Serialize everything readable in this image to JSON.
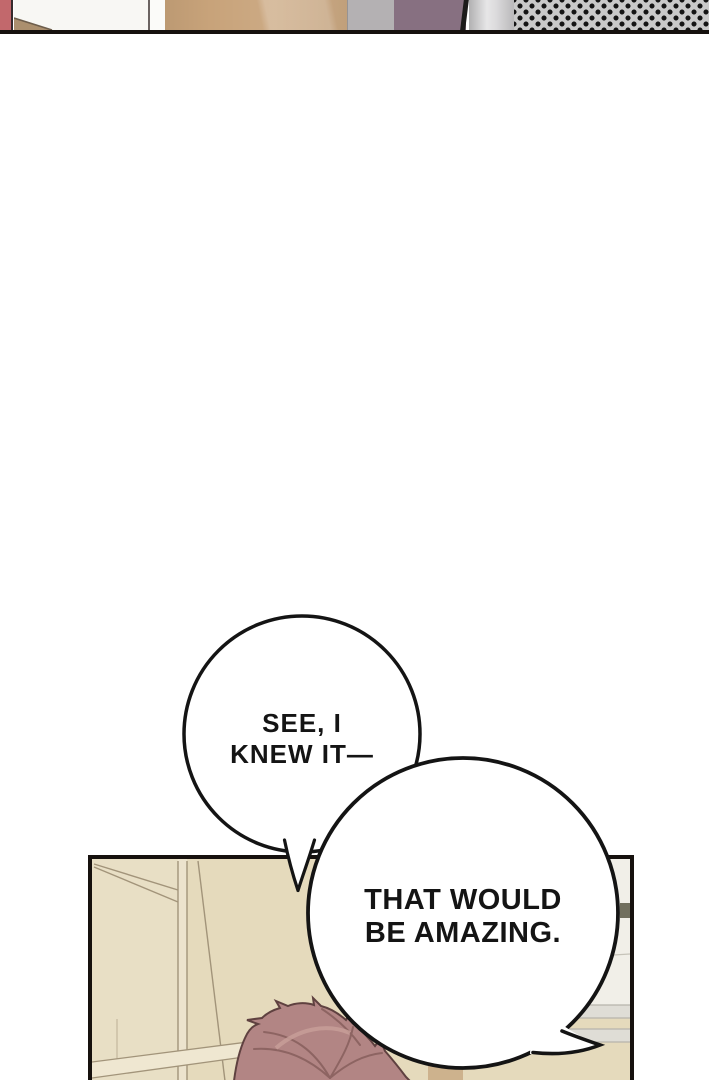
{
  "page": {
    "kind": "webtoon-comic-page",
    "background": "#ffffff",
    "ink_color": "#16110e"
  },
  "top_strip": {
    "border_color": "#16110e",
    "segments": [
      {
        "name": "rose-wall",
        "color": "#c2686c"
      },
      {
        "name": "white-wall",
        "color": "#f8f7f4"
      },
      {
        "name": "tan-floor-wedge",
        "color": "#ab8f6e",
        "edge_color": "#6e5e4c"
      },
      {
        "name": "door-jamb",
        "color": "#fbfbf9"
      },
      {
        "name": "wood-cabinet",
        "color": "#c8a37a"
      },
      {
        "name": "gray-panel",
        "color": "#b4b1b3"
      },
      {
        "name": "purple-drape",
        "color": "#877081"
      },
      {
        "name": "silver-frame",
        "color": "#d3d2d4"
      },
      {
        "name": "halftone-screen",
        "base_color": "#c9c9c9",
        "dot_color": "#141414"
      }
    ]
  },
  "bubbles": [
    {
      "name": "speech-bubble-1",
      "lines": [
        "SEE, I",
        "KNEW IT—"
      ],
      "fill": "#ffffff",
      "stroke": "#141414"
    },
    {
      "name": "speech-bubble-2",
      "lines": [
        "THAT WOULD",
        "BE AMAZING."
      ],
      "fill": "#ffffff",
      "stroke": "#141414"
    }
  ],
  "bottom_panel": {
    "border_color": "#16110e",
    "wall_color": "#e5dabc",
    "wall_light_color": "#ece3cd",
    "trim_line_color": "#a2947a",
    "rail_color": "#efe7d1",
    "alcove_color": "#f1efe8",
    "band_color": "#dfddd6",
    "furniture_color": "#cdb28d",
    "dark_object_color": "#716f5e",
    "hair": {
      "base": "#b28584",
      "shadow": "#8d6462",
      "highlight": "#c79d98",
      "outline": "#5f4140"
    }
  }
}
